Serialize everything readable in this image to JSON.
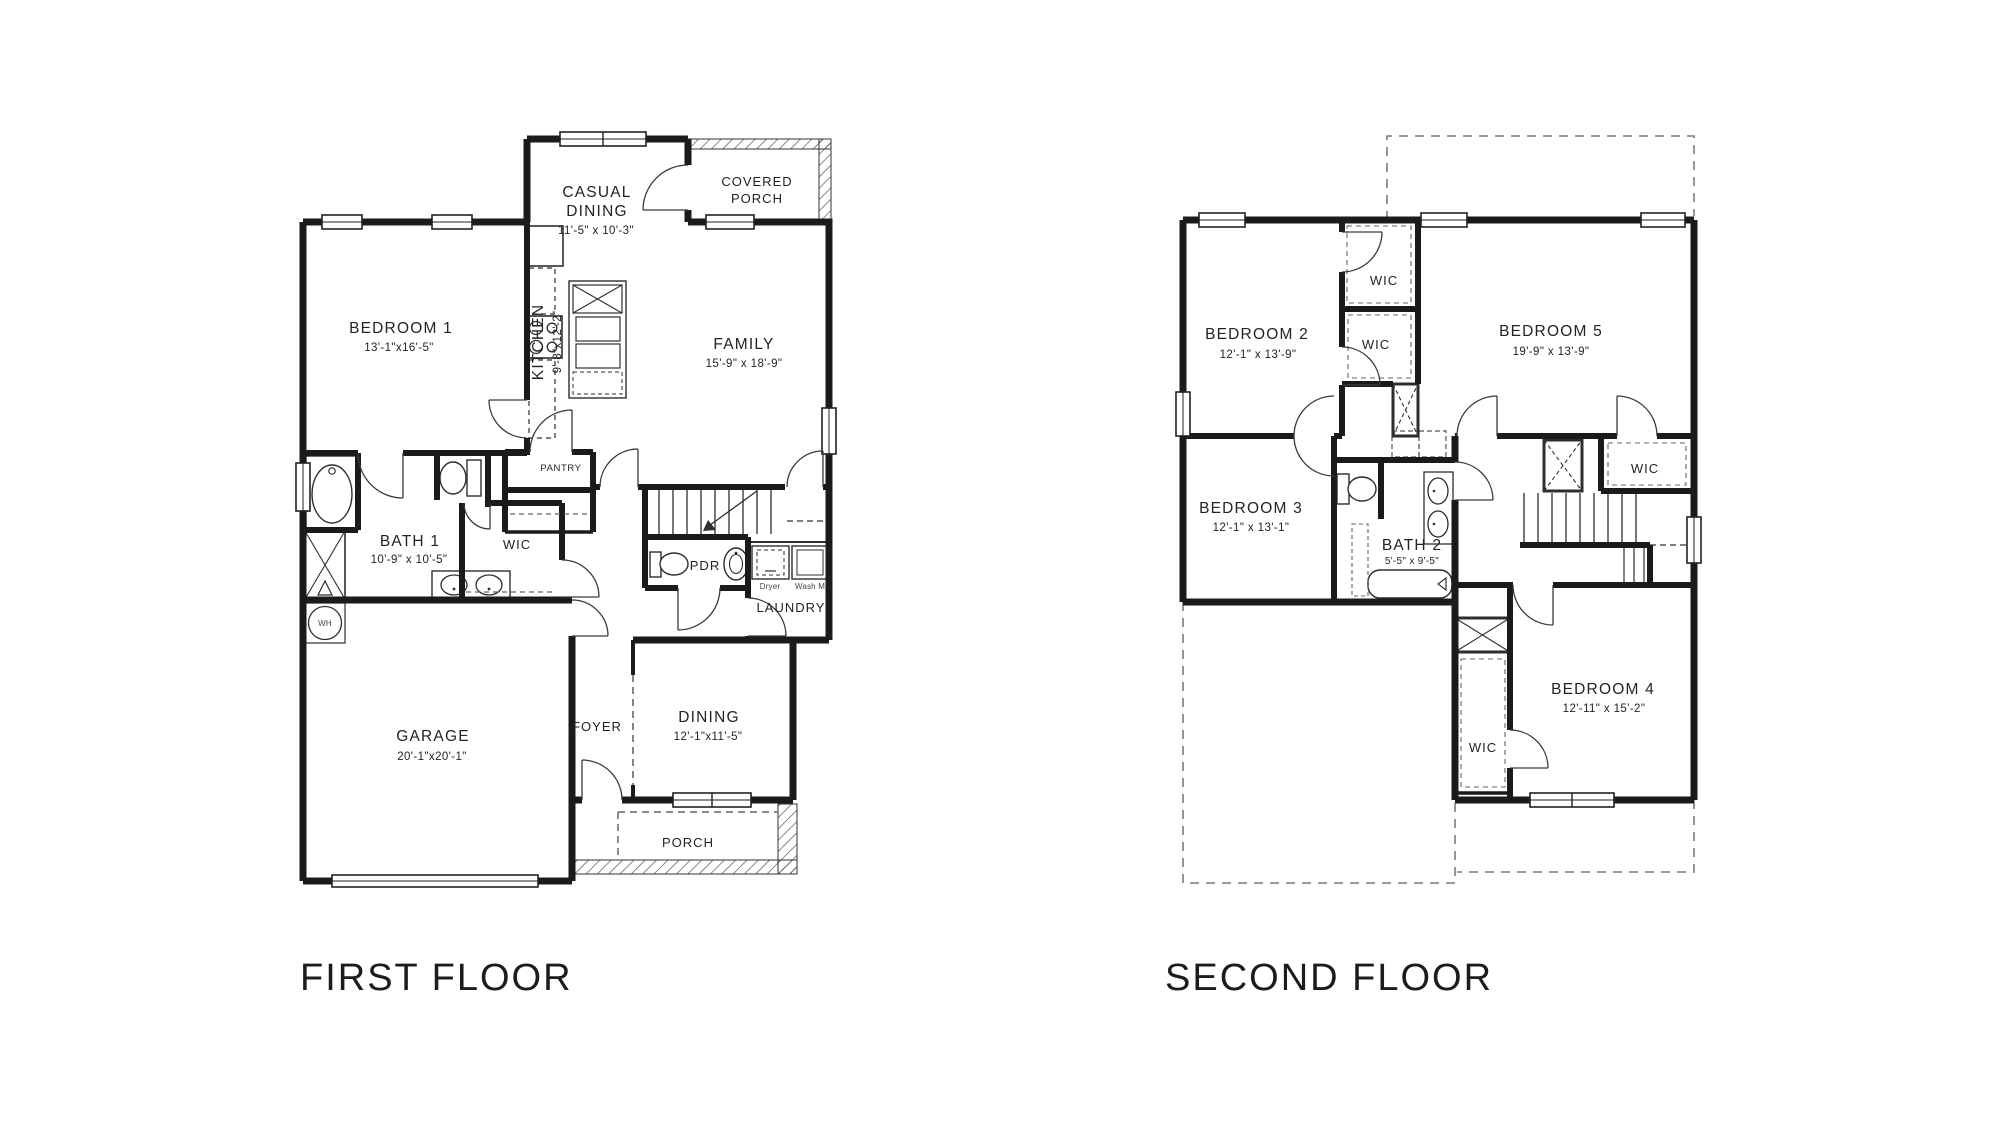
{
  "page": {
    "background": "#ffffff",
    "wall_color": "#1b1b1b",
    "type": "architectural-floor-plan"
  },
  "first_floor": {
    "title": "FIRST FLOOR",
    "rooms": {
      "casual_dining": {
        "line1": "CASUAL",
        "line2": "DINING",
        "dims": "11'-5\" x 10'-3\""
      },
      "covered_porch": {
        "line1": "COVERED",
        "line2": "PORCH"
      },
      "bedroom1": {
        "name": "BEDROOM 1",
        "dims": "13'-1\"x16'-5\""
      },
      "kitchen": {
        "name": "KITCHEN",
        "dims": "9'-8\"x12'-2\""
      },
      "family": {
        "name": "FAMILY",
        "dims": "15'-9\" x 18'-9\""
      },
      "pantry": {
        "name": "PANTRY"
      },
      "bath1": {
        "name": "BATH 1",
        "dims": "10'-9\" x 10'-5\""
      },
      "wic": {
        "name": "WIC"
      },
      "pdr": {
        "name": "PDR"
      },
      "laundry": {
        "name": "LAUNDRY",
        "dryer": "Dryer",
        "washer": "Wash M"
      },
      "water_heater": {
        "name": "WH"
      },
      "garage": {
        "name": "GARAGE",
        "dims": "20'-1\"x20'-1\""
      },
      "foyer": {
        "name": "FOYER"
      },
      "dining": {
        "name": "DINING",
        "dims": "12'-1\"x11'-5\""
      },
      "porch": {
        "name": "PORCH"
      }
    }
  },
  "second_floor": {
    "title": "SECOND FLOOR",
    "rooms": {
      "bedroom2": {
        "name": "BEDROOM 2",
        "dims": "12'-1\" x 13'-9\""
      },
      "wic_top": {
        "name": "WIC"
      },
      "wic_mid": {
        "name": "WIC"
      },
      "bedroom5": {
        "name": "BEDROOM 5",
        "dims": "19'-9\" x 13'-9\""
      },
      "wic_right": {
        "name": "WIC"
      },
      "bedroom3": {
        "name": "BEDROOM 3",
        "dims": "12'-1\" x 13'-1\""
      },
      "bath2": {
        "name": "BATH 2",
        "dims": "5'-5\" x 9'-5\""
      },
      "bedroom4": {
        "name": "BEDROOM 4",
        "dims": "12'-11\" x 15'-2\""
      },
      "wic_bottom": {
        "name": "WIC"
      }
    }
  }
}
